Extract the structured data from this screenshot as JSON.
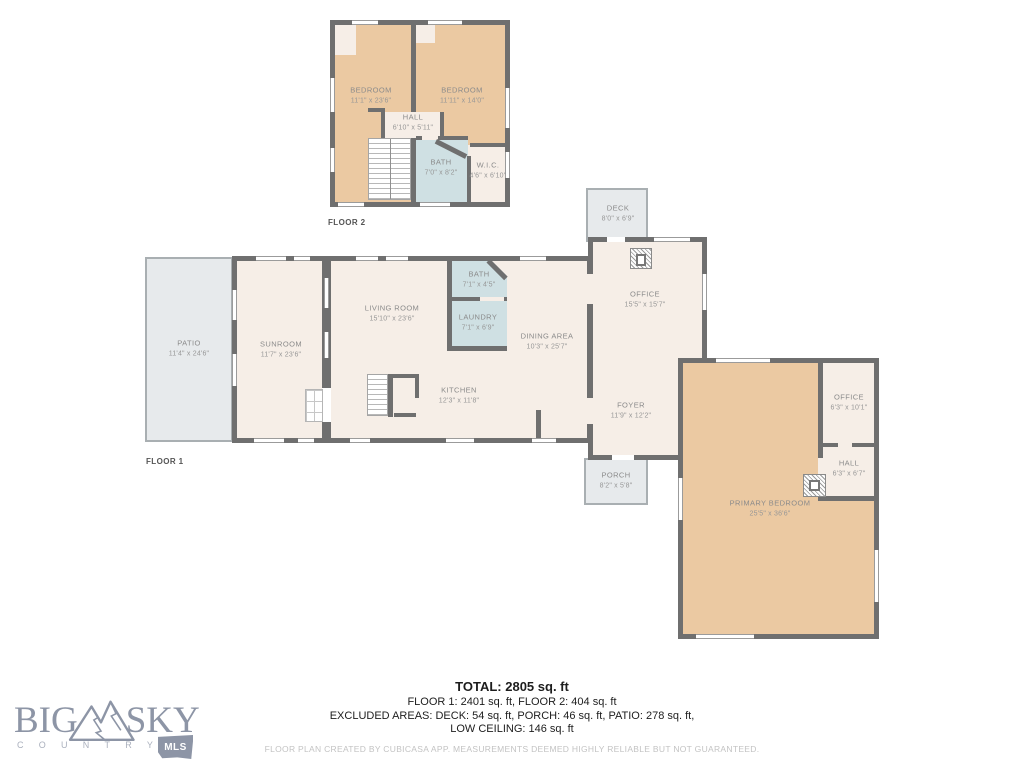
{
  "colors": {
    "wall": "#6f6f6f",
    "cream": "#f6eee7",
    "tan": "#ebc9a2",
    "wet": "#cfe0e3",
    "outdoor": "#e7eaec",
    "label": "#8b8b8b",
    "logo": "#8d95a6"
  },
  "floor2": {
    "label": "FLOOR 2",
    "rooms": [
      {
        "id": "bedroom-left",
        "name": "BEDROOM",
        "dims": "11'1\" x 23'6\""
      },
      {
        "id": "bedroom-right",
        "name": "BEDROOM",
        "dims": "11'11\" x 14'0\""
      },
      {
        "id": "hall",
        "name": "HALL",
        "dims": "6'10\" x 5'11\""
      },
      {
        "id": "bath",
        "name": "BATH",
        "dims": "7'0\" x 8'2\""
      },
      {
        "id": "wic",
        "name": "W.I.C.",
        "dims": "4'6\" x 6'10\""
      }
    ]
  },
  "floor1": {
    "label": "FLOOR 1",
    "rooms": [
      {
        "id": "patio",
        "name": "PATIO",
        "dims": "11'4\" x 24'6\""
      },
      {
        "id": "sunroom",
        "name": "SUNROOM",
        "dims": "11'7\" x 23'6\""
      },
      {
        "id": "living-room",
        "name": "LIVING ROOM",
        "dims": "15'10\" x 23'6\""
      },
      {
        "id": "bath",
        "name": "BATH",
        "dims": "7'1\" x 4'5\""
      },
      {
        "id": "laundry",
        "name": "LAUNDRY",
        "dims": "7'1\" x 6'9\""
      },
      {
        "id": "dining-area",
        "name": "DINING AREA",
        "dims": "10'3\" x 25'7\""
      },
      {
        "id": "kitchen",
        "name": "KITCHEN",
        "dims": "12'3\" x 11'8\""
      },
      {
        "id": "office",
        "name": "OFFICE",
        "dims": "15'5\" x 15'7\""
      },
      {
        "id": "deck",
        "name": "DECK",
        "dims": "8'0\" x 6'9\""
      },
      {
        "id": "foyer",
        "name": "FOYER",
        "dims": "11'9\" x 12'2\""
      },
      {
        "id": "porch",
        "name": "PORCH",
        "dims": "8'2\" x 5'8\""
      },
      {
        "id": "primary-bedroom",
        "name": "PRIMARY BEDROOM",
        "dims": "25'5\" x 36'6\""
      },
      {
        "id": "office-small",
        "name": "OFFICE",
        "dims": "6'3\" x 10'1\""
      },
      {
        "id": "hall",
        "name": "HALL",
        "dims": "6'3\" x 6'7\""
      }
    ]
  },
  "summary": {
    "total": "TOTAL: 2805 sq. ft",
    "floors": "FLOOR 1: 2401 sq. ft, FLOOR 2: 404 sq. ft",
    "excluded": "EXCLUDED AREAS: DECK: 54 sq. ft, PORCH: 46 sq. ft, PATIO: 278 sq. ft,",
    "low_ceiling": "LOW CEILING: 146 sq. ft",
    "disclaimer": "FLOOR PLAN CREATED BY CUBICASA APP. MEASUREMENTS DEEMED HIGHLY RELIABLE BUT NOT GUARANTEED."
  },
  "logo": {
    "big": "BIG",
    "sky": "SKY",
    "country": "COUNTRY",
    "mls": "MLS"
  }
}
